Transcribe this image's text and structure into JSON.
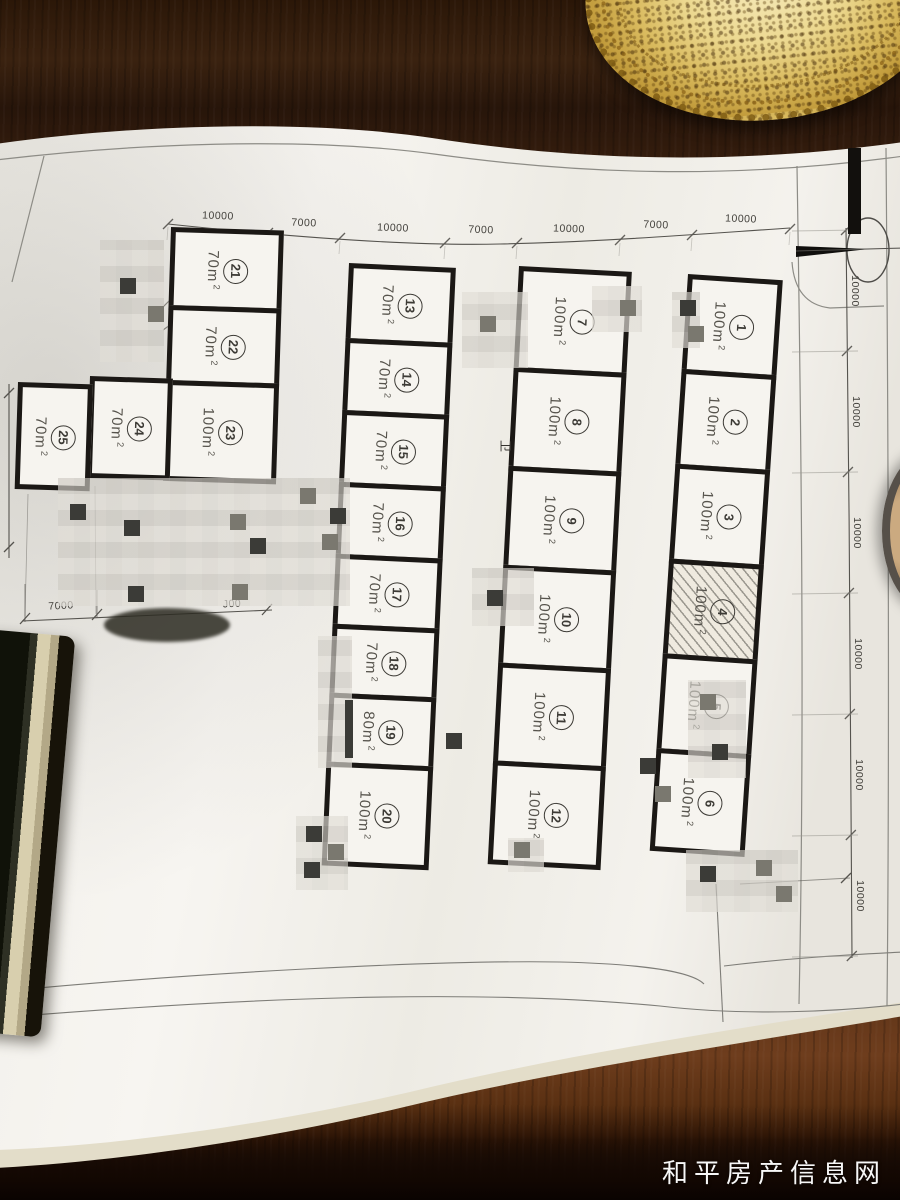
{
  "photo": {
    "watermark": "和平房产信息网"
  },
  "plan": {
    "corridor_glyph": "卫",
    "units": [
      {
        "no": "1",
        "area": "100m",
        "sup": "2",
        "hatched": false
      },
      {
        "no": "2",
        "area": "100m",
        "sup": "2",
        "hatched": false
      },
      {
        "no": "3",
        "area": "100m",
        "sup": "2",
        "hatched": false
      },
      {
        "no": "4",
        "area": "100m",
        "sup": "2",
        "hatched": true
      },
      {
        "no": "5",
        "area": "100m",
        "sup": "2",
        "hatched": false
      },
      {
        "no": "6",
        "area": "100m",
        "sup": "2",
        "hatched": false
      },
      {
        "no": "7",
        "area": "100m",
        "sup": "2",
        "hatched": false
      },
      {
        "no": "8",
        "area": "100m",
        "sup": "2",
        "hatched": false
      },
      {
        "no": "9",
        "area": "100m",
        "sup": "2",
        "hatched": false
      },
      {
        "no": "10",
        "area": "100m",
        "sup": "2",
        "hatched": false
      },
      {
        "no": "11",
        "area": "100m",
        "sup": "2",
        "hatched": false
      },
      {
        "no": "12",
        "area": "100m",
        "sup": "2",
        "hatched": false
      },
      {
        "no": "13",
        "area": "70m",
        "sup": "2",
        "hatched": false
      },
      {
        "no": "14",
        "area": "70m",
        "sup": "2",
        "hatched": false
      },
      {
        "no": "15",
        "area": "70m",
        "sup": "2",
        "hatched": false
      },
      {
        "no": "16",
        "area": "70m",
        "sup": "2",
        "hatched": false
      },
      {
        "no": "17",
        "area": "70m",
        "sup": "2",
        "hatched": false
      },
      {
        "no": "18",
        "area": "70m",
        "sup": "2",
        "hatched": false
      },
      {
        "no": "19",
        "area": "80m",
        "sup": "2",
        "hatched": false
      },
      {
        "no": "20",
        "area": "100m",
        "sup": "2",
        "hatched": false
      },
      {
        "no": "21",
        "area": "70m",
        "sup": "2",
        "hatched": false
      },
      {
        "no": "22",
        "area": "70m",
        "sup": "2",
        "hatched": false
      },
      {
        "no": "23",
        "area": "100m",
        "sup": "2",
        "hatched": false
      },
      {
        "no": "24",
        "area": "70m",
        "sup": "2",
        "hatched": false
      },
      {
        "no": "25",
        "area": "70m",
        "sup": "2",
        "hatched": false
      }
    ]
  },
  "dimensions": {
    "top": [
      "10000",
      "7000",
      "10000",
      "7000",
      "10000",
      "7000",
      "10000"
    ],
    "right": [
      "10000",
      "10000",
      "10000",
      "10000",
      "10000",
      "10000"
    ],
    "left": "10000",
    "bottom": [
      "7000",
      "J00"
    ]
  }
}
